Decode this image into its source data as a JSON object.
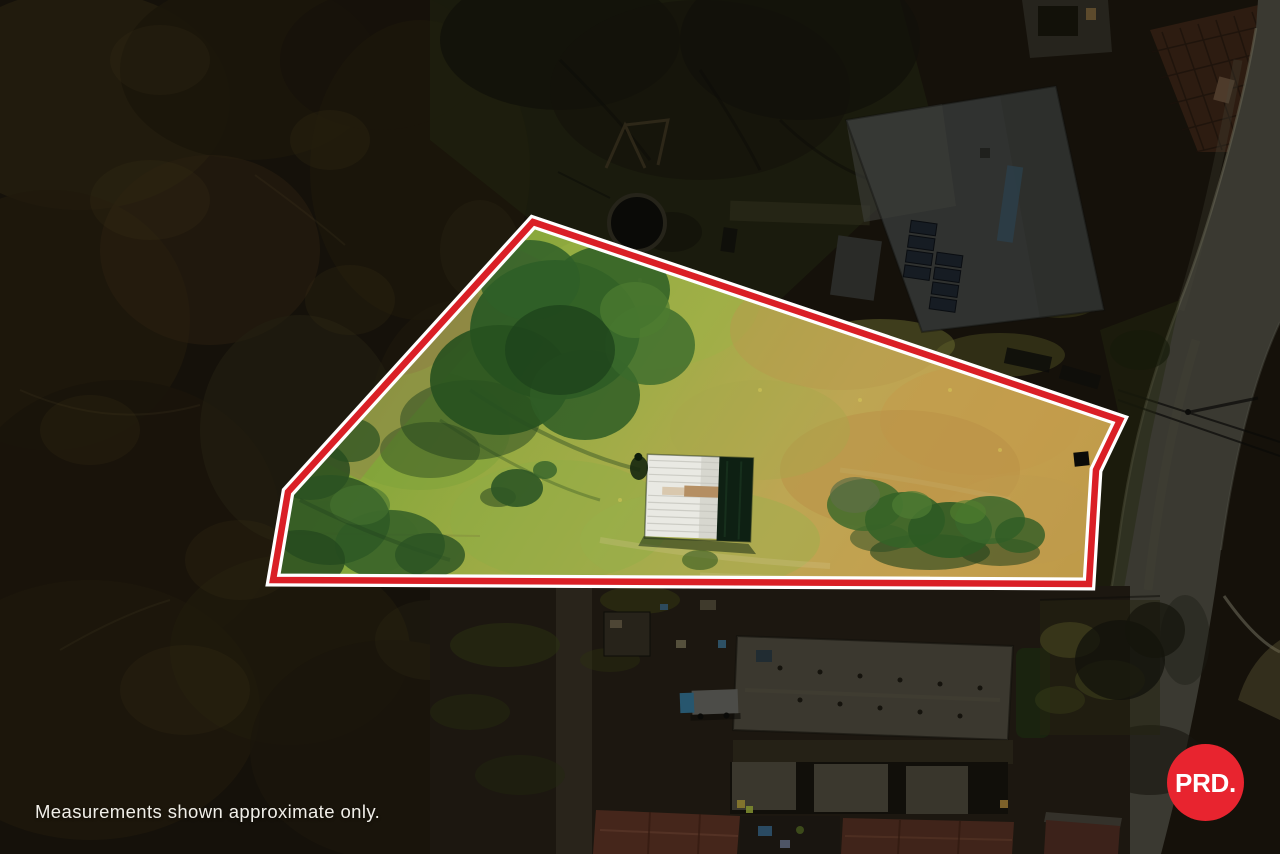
{
  "overlay": {
    "disclaimer": "Measurements shown approximate only.",
    "logo": {
      "text": "PRD."
    },
    "colors": {
      "boundary_red": "#da1f26",
      "boundary_outline_white": "#ffffff",
      "logo_background": "#e8242f",
      "logo_text": "#ffffff"
    }
  }
}
